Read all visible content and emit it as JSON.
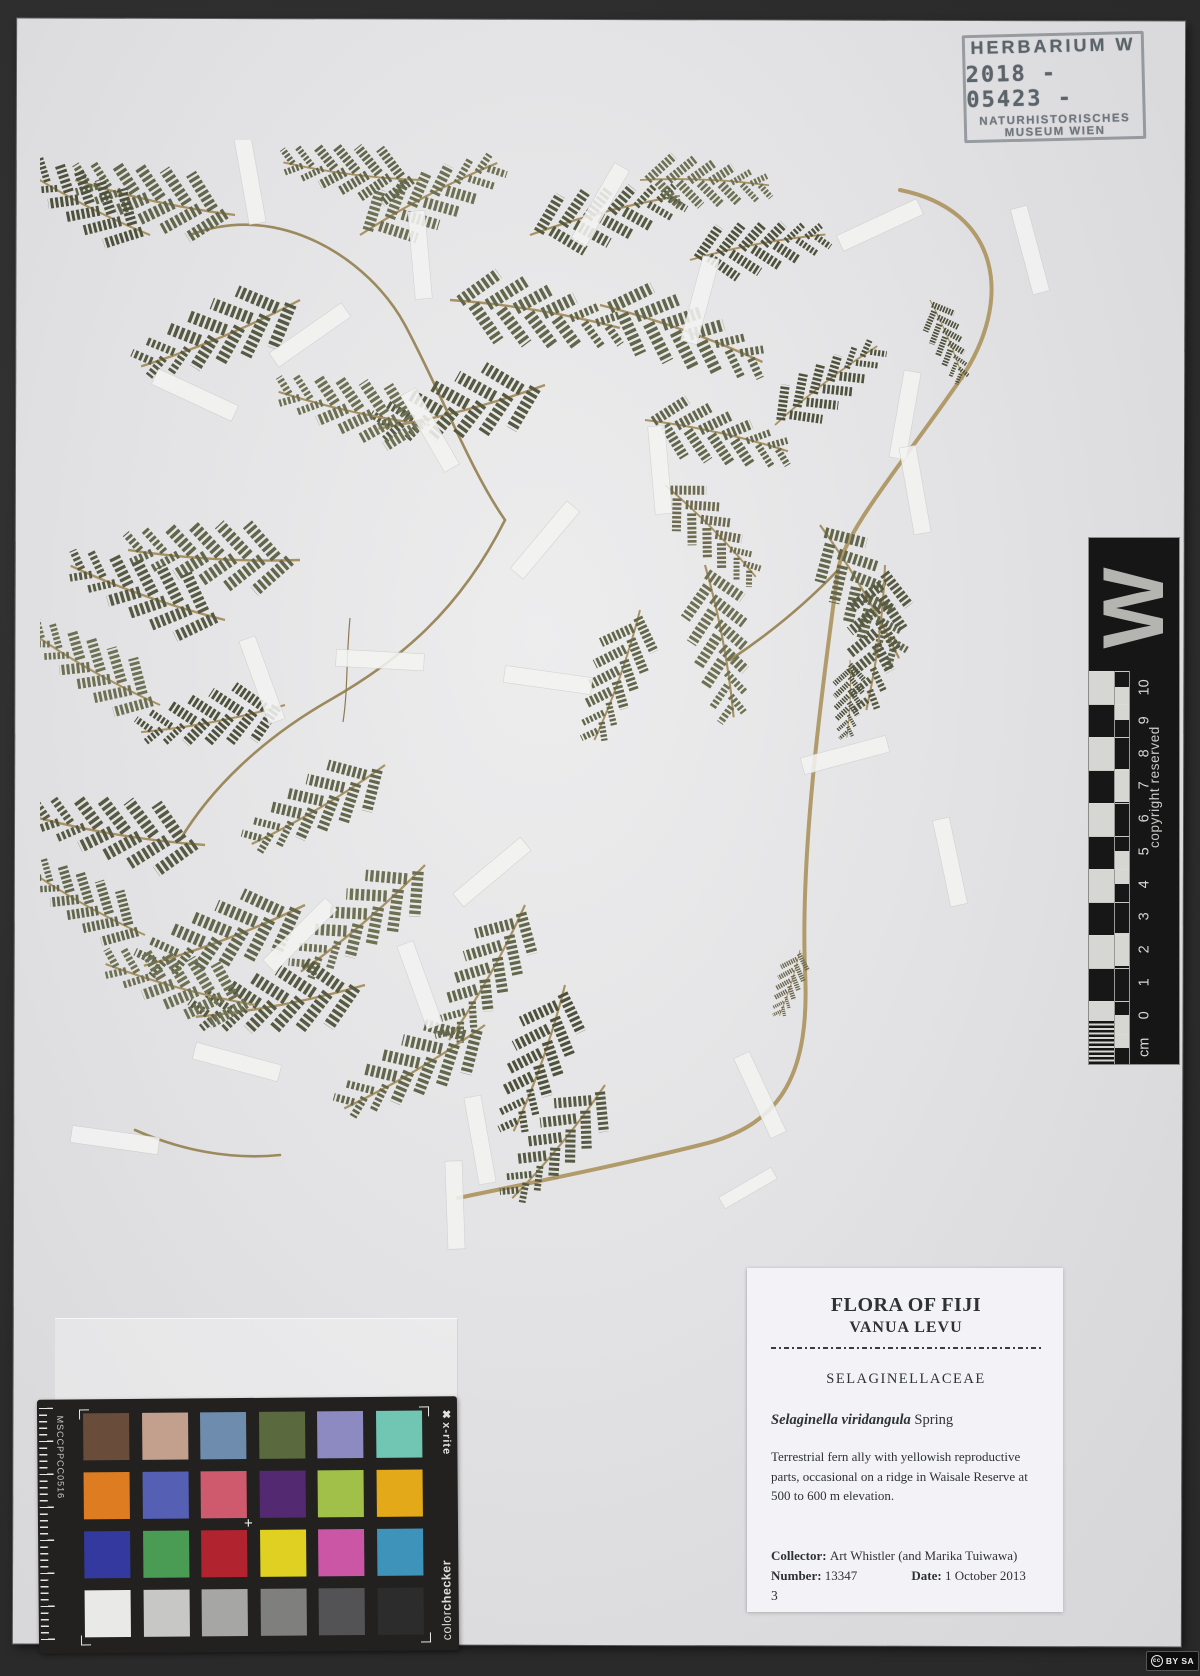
{
  "stamp": {
    "line1": "HERBARIUM W",
    "line2": "2018 - 05423 -",
    "line3": "NATURHISTORISCHES",
    "line4": "MUSEUM WIEN"
  },
  "ruler": {
    "letter": "W",
    "copyright": "copyright reserved",
    "ticks": [
      "10",
      "9",
      "8",
      "7",
      "6",
      "5",
      "4",
      "3",
      "2",
      "1",
      "0"
    ],
    "unit": "cm"
  },
  "colorchecker": {
    "serial": "MSCCPPCC0516",
    "brand": "x-rite",
    "brand_icon": "✖",
    "product_regular": "color",
    "product_bold": "checker",
    "center_mark": "+",
    "patches": [
      "#6a4c3a",
      "#c39f8d",
      "#6e8cad",
      "#5a6a3e",
      "#8c8ac1",
      "#70c5b3",
      "#dd7c21",
      "#5560b5",
      "#d05a6d",
      "#532a72",
      "#a0c04a",
      "#e3a918",
      "#3439a0",
      "#4a9b54",
      "#b0232f",
      "#dfd022",
      "#cc56a6",
      "#3e93bb",
      "#e9e9e7",
      "#c7c7c5",
      "#a6a6a4",
      "#7f7f7d",
      "#535355",
      "#2c2c2c"
    ]
  },
  "label": {
    "title": "FLORA OF FIJI",
    "subtitle": "VANUA LEVU",
    "family": "SELAGINELLACEAE",
    "species": "Selaginella viridangula",
    "author": " Spring",
    "description": "Terrestrial fern ally with yellowish reproductive parts, occasional on a ridge in Waisale Reserve at 500 to 600 m elevation.",
    "collector_label": "Collector: ",
    "collector": "Art Whistler (and Marika Tuiwawa)",
    "number_label": "Number: ",
    "number": "13347",
    "date_label": "Date: ",
    "date": "1 October 2013",
    "sheet_number": "3"
  },
  "license": {
    "cc": "cc",
    "text": "BY SA"
  },
  "colors": {
    "photo_background": "#2e2e2e",
    "sheet": "#e3e3e5",
    "plant_foliage": "#62664b",
    "plant_stem": "#b19b6b",
    "stamp_ink": "#4b545c",
    "ruler_black": "#161616"
  }
}
